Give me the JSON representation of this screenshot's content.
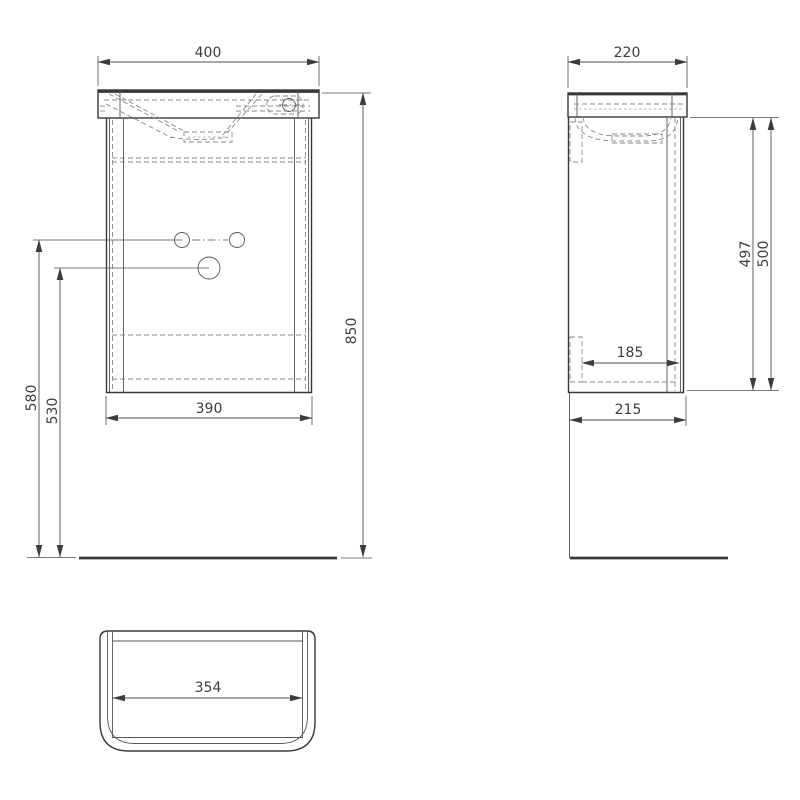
{
  "drawing": {
    "background_color": "#ffffff",
    "outline_color": "#383838",
    "hidden_line_color": "#8a8a8a",
    "dimension_color": "#4d4d4d",
    "front_view": {
      "dims": {
        "top_width": "400",
        "overall_height": "850",
        "body_width": "390",
        "small_holes_height": "580",
        "large_hole_height": "530"
      }
    },
    "side_view": {
      "dims": {
        "top_depth": "220",
        "front_height_inner": "497",
        "front_height": "500",
        "rail_clearance": "185",
        "body_depth": "215"
      }
    },
    "bottom_view": {
      "dims": {
        "inner_width": "354"
      }
    }
  }
}
